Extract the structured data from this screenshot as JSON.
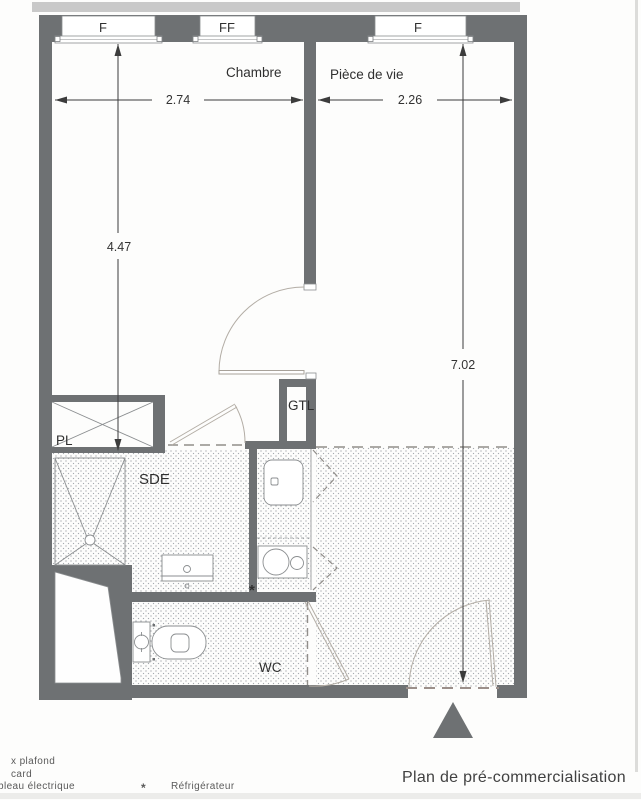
{
  "windows": {
    "w1": "F",
    "w2": "FF",
    "w3": "F"
  },
  "rooms": {
    "chambre": "Chambre",
    "piece_de_vie": "Pièce de vie",
    "sde": "SDE",
    "gtl": "GTL",
    "pl": "PL",
    "wc": "WC"
  },
  "dimensions": {
    "chambre_width": "2.74",
    "piece_width": "2.26",
    "chambre_depth": "4.47",
    "total_depth": "7.02"
  },
  "kitchen": {
    "fridge_marker": "*"
  },
  "legend": {
    "line1": "x plafond",
    "line2": "card",
    "line3": "bleau électrique",
    "fridge_symbol": "*",
    "fridge_label": "Réfrigérateur"
  },
  "caption": "Plan de pré-commercialisation",
  "colors": {
    "wall": "#6e7173",
    "stipple_dot": "#9aa0a6",
    "door_arc": "#b3ada5"
  }
}
